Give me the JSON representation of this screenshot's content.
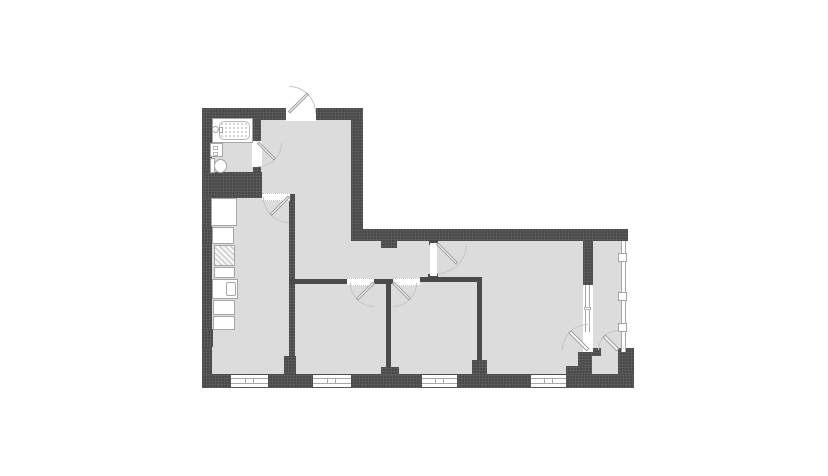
{
  "palette": {
    "background": "#ffffff",
    "wall": "#4a4a4a",
    "floor": "#dcdcdc",
    "line": "#c6c6c6",
    "stroke": "#a6a6a6",
    "opening": "#ffffff"
  },
  "plan": {
    "kind": "apartment-floor-plan",
    "rooms": [
      {
        "id": "bathroom"
      },
      {
        "id": "entry-hall"
      },
      {
        "id": "kitchen"
      },
      {
        "id": "corridor"
      },
      {
        "id": "bedroom-left"
      },
      {
        "id": "bedroom-middle"
      },
      {
        "id": "living-room"
      },
      {
        "id": "balcony"
      }
    ],
    "fixtures": [
      "bathtub",
      "bath-faucet",
      "washing-machine",
      "toilet",
      "kitchen-counter",
      "stove",
      "kitchen-sink"
    ],
    "doors": [
      "entry-door",
      "bathroom-door",
      "kitchen-door",
      "bedroom-left-door",
      "bedroom-middle-door",
      "living-room-door",
      "balcony-door",
      "balcony-outer-door"
    ],
    "windows": [
      "kitchen-window",
      "bedroom-left-window",
      "bedroom-middle-window",
      "living-room-window",
      "balcony-window",
      "balcony-glazing"
    ]
  }
}
